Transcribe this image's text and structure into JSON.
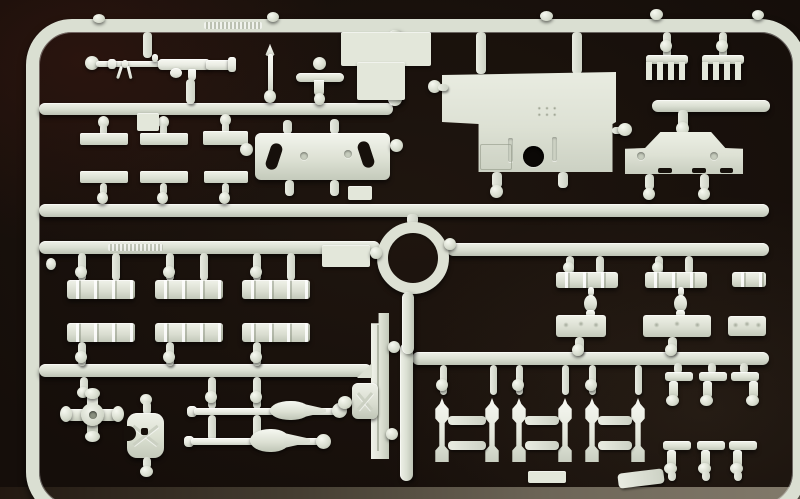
{
  "image": {
    "type": "photograph",
    "subject": "injection-molded plastic model kit sprue (parts tree) on a dark surface",
    "width_px": 800,
    "height_px": 499,
    "visible_text": ""
  },
  "colors": {
    "background": "#150e0a",
    "background_tint_top_left": "#3a1a12",
    "table_edge": "#8d8575",
    "plastic_base": "#dde1d4",
    "plastic_highlight": "#f3f5ed",
    "plastic_shadow": "#b2b8a9",
    "hatch_hole": "#0b0806"
  },
  "sprue": {
    "frame_shape": "rounded-rectangle",
    "parts": [
      {
        "id": "machine-gun",
        "label": "machine gun with drum magazine",
        "count": 1
      },
      {
        "id": "cross-handle",
        "label": "cross/T handle key",
        "count": 1
      },
      {
        "id": "small-pin",
        "label": "small pointed pin",
        "count": 1
      },
      {
        "id": "flat-strips",
        "label": "small flat mounting strips",
        "count": 6
      },
      {
        "id": "slotted-plate",
        "label": "rectangular plate with two angled slots",
        "count": 1
      },
      {
        "id": "roof-plate",
        "label": "large stepped hull plate with round hatch hole",
        "count": 1
      },
      {
        "id": "grouser-combs",
        "label": "comb-shaped track grousers",
        "count": 2
      },
      {
        "id": "skirt-panel",
        "label": "side-skirt / fender panel",
        "count": 1
      },
      {
        "id": "turret-ring",
        "label": "circular turret ring",
        "count": 1
      },
      {
        "id": "ribbed-strips",
        "label": "ribbed hatch strips",
        "count": 10
      },
      {
        "id": "bollard-pins",
        "label": "small bollard pins",
        "count": 2
      },
      {
        "id": "hub-cross",
        "label": "four-arm wheel hub cross",
        "count": 1
      },
      {
        "id": "buckle-bracket",
        "label": "buckle-shaped bracket with X brace",
        "count": 1
      },
      {
        "id": "projectile-rods",
        "label": "rod parts with teardrop warheads",
        "count": 2
      },
      {
        "id": "jack-plank",
        "label": "long jack plank",
        "count": 1
      },
      {
        "id": "folding-jack",
        "label": "small folded scissor jack",
        "count": 1
      },
      {
        "id": "suspension-pins",
        "label": "suspension pin posts",
        "count": 6
      },
      {
        "id": "l-brackets",
        "label": "small L-brackets",
        "count": 6
      }
    ]
  }
}
